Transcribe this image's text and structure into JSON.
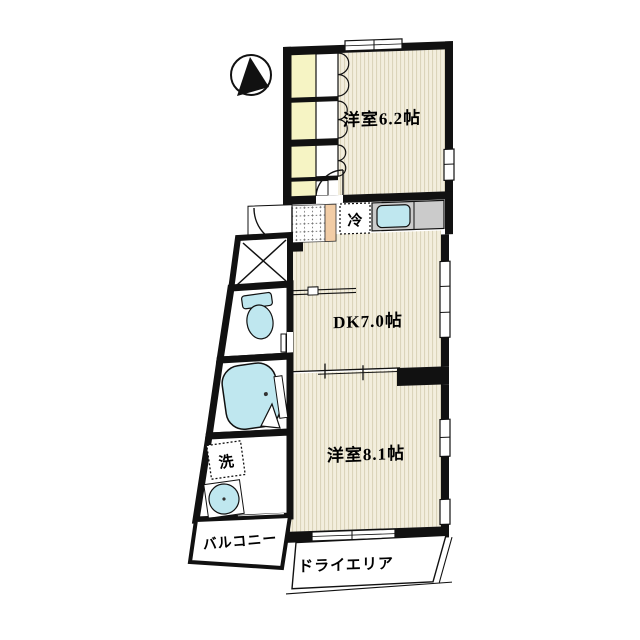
{
  "plan": {
    "title": "apartment-floor-plan",
    "rooms": {
      "bedroom_top": {
        "label": "洋室6.2帖"
      },
      "dining_kitchen": {
        "label": "DK7.0帖"
      },
      "bedroom_bottom": {
        "label": "洋室8.1帖"
      }
    },
    "outdoor": {
      "balcony": {
        "label": "バルコニー"
      },
      "dry_area": {
        "label": "ドライエリア"
      }
    },
    "fixtures": {
      "refrigerator": {
        "label": "冷"
      },
      "washing_machine": {
        "label": "洗"
      }
    },
    "colors": {
      "wall": "#111111",
      "floor": "#f3eedd",
      "floor-stripe": "#d9d2b8",
      "closet": "#f6f4c4",
      "fixture-blue": "#bfe7ef",
      "counter-gray": "#cbcbcb",
      "step-salmon": "#f2cda6",
      "outline": "#000000"
    }
  }
}
